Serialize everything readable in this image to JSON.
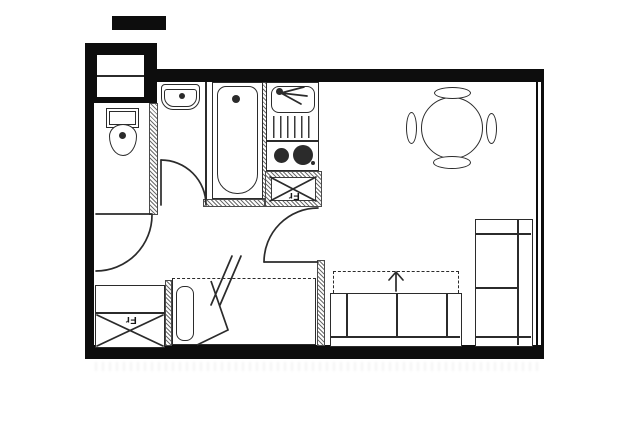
{
  "title": "Studio apartment floor plan",
  "colors": {
    "wall": "#0d0d0d",
    "line": "#2b2b2b",
    "background": "#ffffff"
  },
  "labels": {
    "kitchen_fridge": "Fr",
    "entry_fridge": "Fr"
  },
  "fixtures": [
    "toilet",
    "washbasin",
    "bathtub",
    "kitchen-sink",
    "cooktop",
    "refrigerator-box",
    "dining-table",
    "chair",
    "bed",
    "pillow",
    "sofa-bed",
    "fold-out-arrow",
    "wardrobe",
    "built-in-closet",
    "door-swing",
    "window-wall"
  ]
}
